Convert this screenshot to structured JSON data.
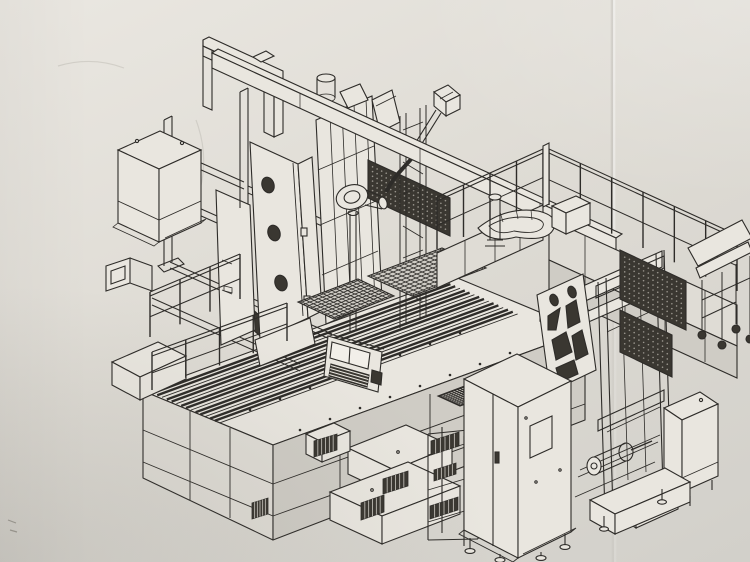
{
  "figure": {
    "domain": "technical-diagram",
    "type": "isometric-line-drawing",
    "subject": "large CNC machining center with overhead gantry loader, perimeter guard fencing, T-slot bed table, spindle tower and electrical control cabinet",
    "medium": "printed engineering drawing photographed on lightly creased paper",
    "visible_text": []
  },
  "palette": {
    "paper_light": "#eae7e1",
    "paper_mid": "#dedbd4",
    "paper_dark": "#d2d0ca",
    "ink": "#2e2c29",
    "face_light": "#e9e6df",
    "face_mid": "#dfdcd5",
    "face_dark": "#cfccc5",
    "panel_dark": "#3a3731",
    "mesh_dot": "#9a968e",
    "scuff": "#c9c6bf"
  },
  "components": [
    "gantry-beam",
    "portal-frame",
    "hanging-electrical-box",
    "cable-channel",
    "support-legs",
    "main-column-with-holes",
    "spindle-tower",
    "cable-drum",
    "balancer-rod",
    "energy-chain-track",
    "guard-fence-left-run",
    "guard-fence-right-run",
    "t-slot-bed",
    "bed-skirt",
    "left-bed-fence",
    "walkway-fence",
    "pallet-grids",
    "pendant-panel",
    "chip-ramp",
    "right-gantry-frame",
    "lightened-column",
    "mesh-panels",
    "roller-chute-with-casters",
    "control-cabinet",
    "step-platforms",
    "vent-rack",
    "small-electrical-cabinet",
    "parts-bin",
    "leveling-feet"
  ]
}
